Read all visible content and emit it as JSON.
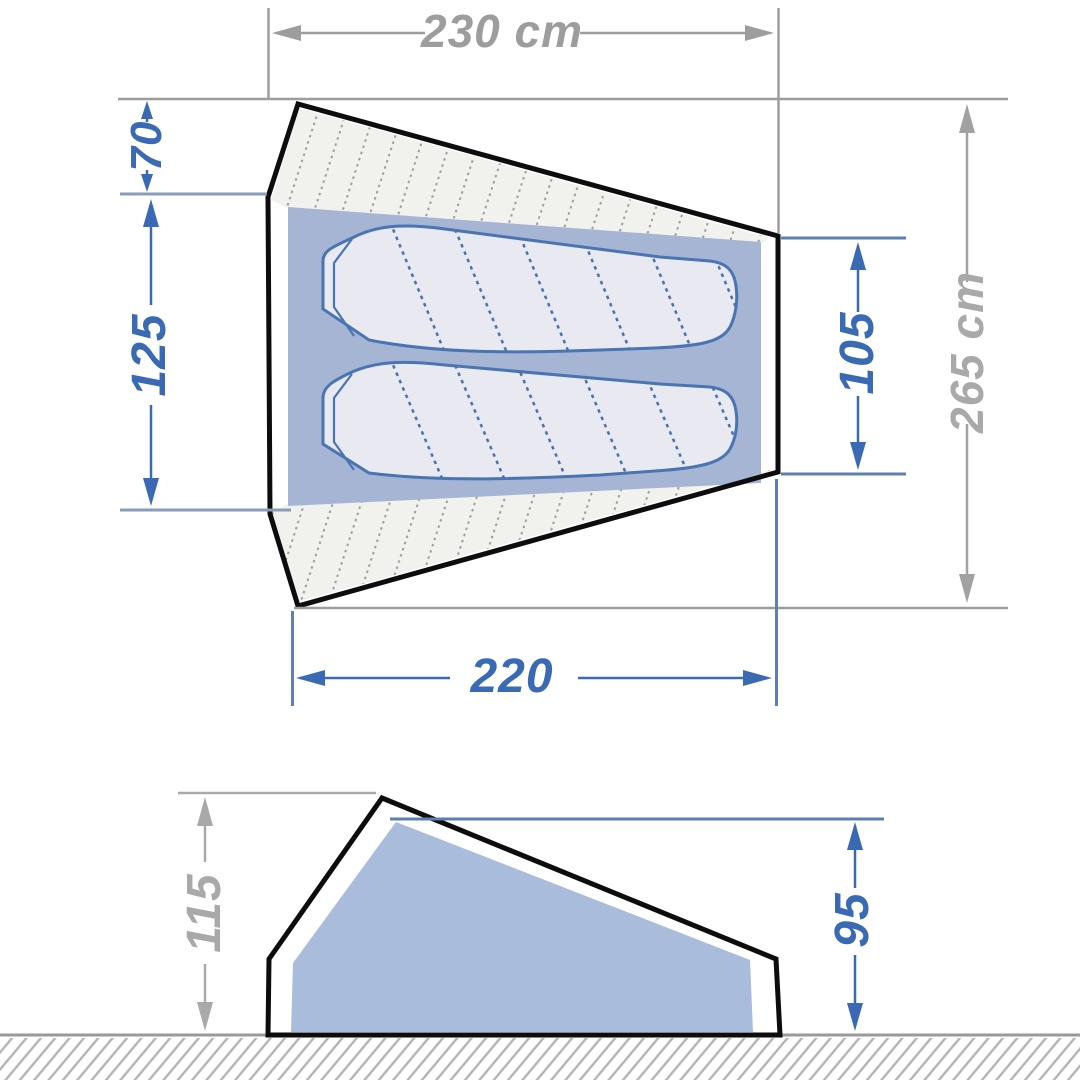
{
  "diagram": {
    "type": "tent-dimension-diagram",
    "dimensions": {
      "outer_width": {
        "label": "230 cm",
        "color": "gray"
      },
      "vestibule_depth": {
        "label": "70",
        "color": "blue"
      },
      "inner_width_left": {
        "label": "125",
        "color": "blue"
      },
      "inner_width_right": {
        "label": "105",
        "color": "blue"
      },
      "outer_length": {
        "label": "265 cm",
        "color": "gray"
      },
      "floor_length": {
        "label": "220",
        "color": "blue"
      },
      "outer_height": {
        "label": "115",
        "color": "gray"
      },
      "inner_height": {
        "label": "95",
        "color": "blue"
      }
    },
    "colors": {
      "dimension_blue": "#3a6ab4",
      "dimension_gray": "#9d9d9d",
      "extension_blue_gray": "#8a9cb8",
      "extension_blue": "#5e80b0",
      "floor_fill": "#a7b5d5",
      "side_inner_fill": "#a9bcdc",
      "sleeping_bag_fill": "#e8e9f1",
      "sleeping_bag_stroke": "#4a74b2",
      "vestibule_fill": "#f1f1ee",
      "hatch_dot": "#9f9f9f",
      "ground_hatch": "#b4b4b4",
      "outline": "#0d0d0d",
      "background": "#ffffff"
    }
  }
}
